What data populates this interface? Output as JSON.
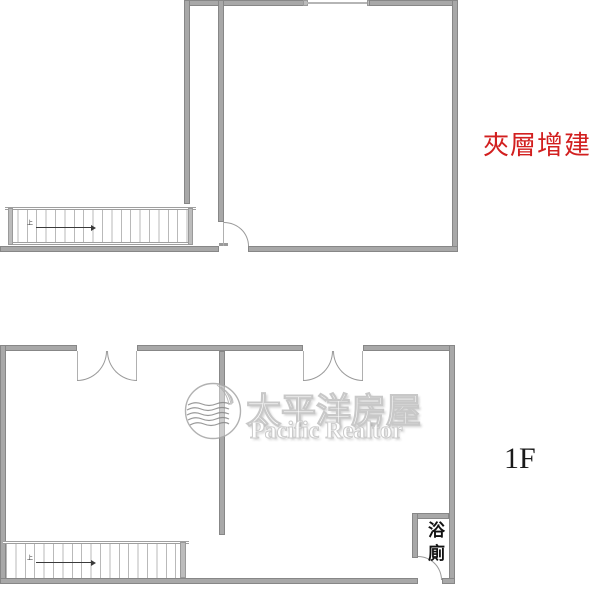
{
  "colors": {
    "wall_fill": "#a8a8a8",
    "wall_edge": "#878787",
    "door_arc": "#9a9a9a",
    "stair_line": "#b9b9b9",
    "mezzanine_label_red": "#d21f1f",
    "floor_label_black": "#1a1a1a",
    "watermark_outline": "#c3c3c3"
  },
  "mezzanine_plan": {
    "label": "夾層增建",
    "stairs": {
      "direction_label": "上"
    }
  },
  "first_floor_plan": {
    "label": "1F",
    "bathroom": {
      "label": "浴廁"
    },
    "stairs": {
      "direction_label": "上"
    }
  },
  "watermark": {
    "brand_cjk": "太平洋房屋",
    "brand_en": "Pacific Realtor"
  }
}
